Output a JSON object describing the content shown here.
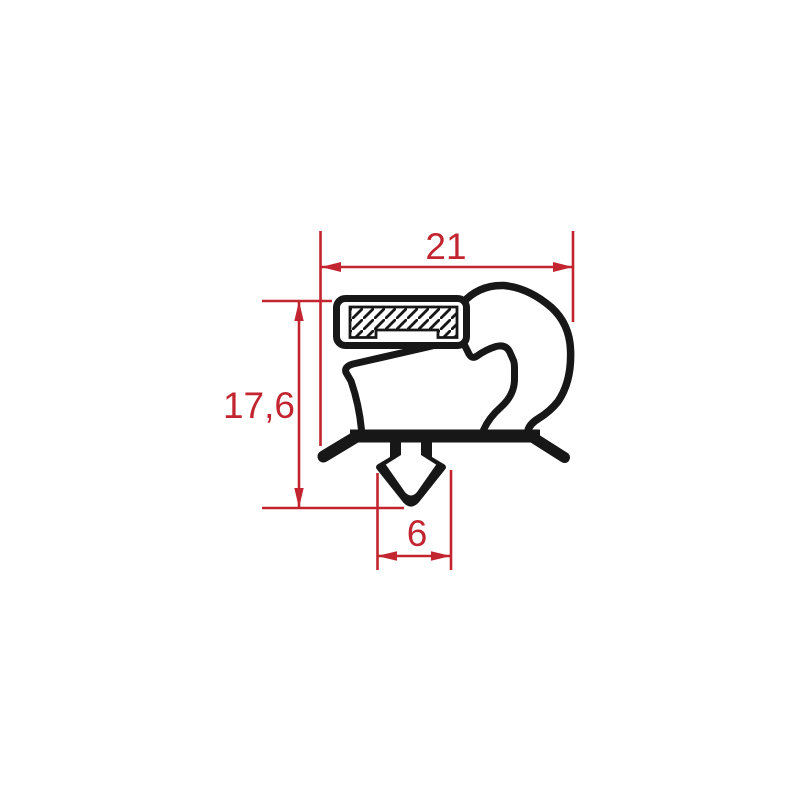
{
  "drawing": {
    "title": "gasket-profile-cross-section",
    "background_color": "#ffffff",
    "profile_color": "#171717",
    "dimension_color": "#c2252f",
    "dimensions": [
      {
        "id": "overall-width",
        "label": "21",
        "orientation": "horizontal",
        "position": "top"
      },
      {
        "id": "overall-height",
        "label": "17,6",
        "orientation": "vertical",
        "position": "left"
      },
      {
        "id": "barb-width",
        "label": "6",
        "orientation": "horizontal",
        "position": "bottom"
      }
    ],
    "parts": [
      "magnet-pocket",
      "magnet-insert-hatched",
      "balloon-bulb",
      "flex-membrane",
      "base-bar",
      "anchor-barb",
      "left-foot",
      "right-foot"
    ]
  }
}
